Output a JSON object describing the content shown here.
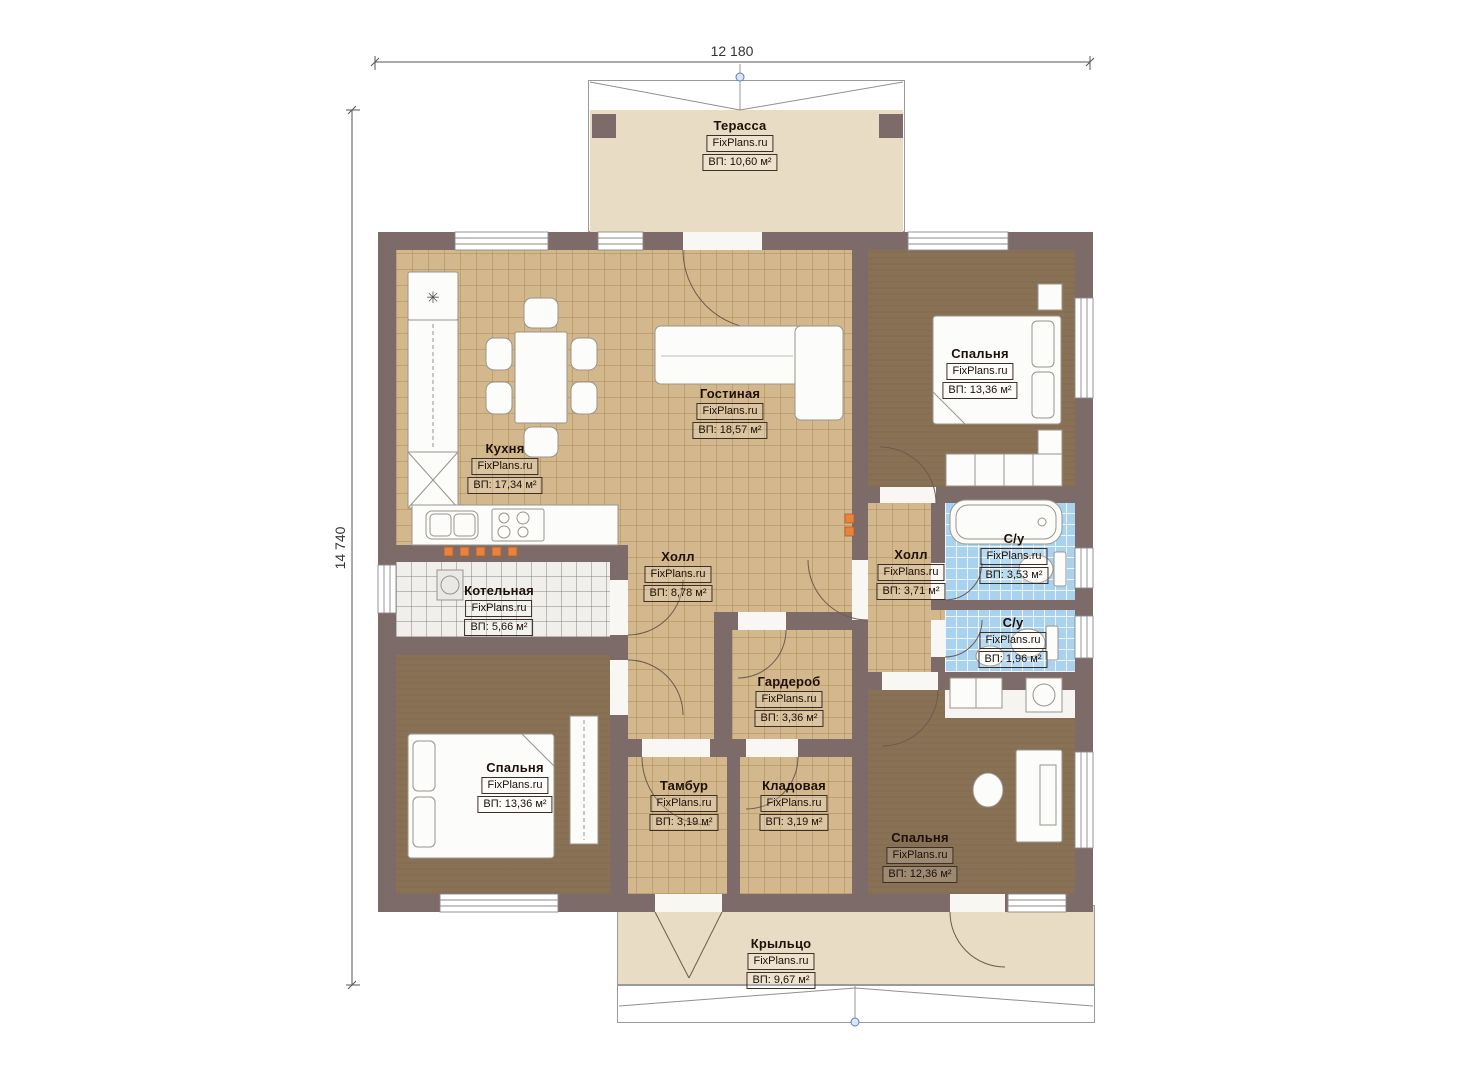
{
  "plan": {
    "watermark": "FixPlans.ru",
    "dimensions": {
      "width_label": "12 180",
      "height_label": "14 740"
    },
    "rooms": [
      {
        "id": "terrace",
        "name": "Терасса",
        "area": "ВП: 10,60 м²"
      },
      {
        "id": "kitchen",
        "name": "Кухня",
        "area": "ВП: 17,34 м²"
      },
      {
        "id": "living",
        "name": "Гостиная",
        "area": "ВП: 18,57 м²"
      },
      {
        "id": "bedroom-top",
        "name": "Спальня",
        "area": "ВП: 13,36 м²"
      },
      {
        "id": "hall-main",
        "name": "Холл",
        "area": "ВП: 8,78 м²"
      },
      {
        "id": "hall-small",
        "name": "Холл",
        "area": "ВП: 3,71 м²"
      },
      {
        "id": "bath-big",
        "name": "С/у",
        "area": "ВП: 3,53 м²"
      },
      {
        "id": "bath-small",
        "name": "С/у",
        "area": "ВП: 1,96 м²"
      },
      {
        "id": "boiler",
        "name": "Котельная",
        "area": "ВП: 5,66 м²"
      },
      {
        "id": "wardrobe",
        "name": "Гардероб",
        "area": "ВП: 3,36 м²"
      },
      {
        "id": "bedroom-left",
        "name": "Спальня",
        "area": "ВП: 13,36 м²"
      },
      {
        "id": "tambour",
        "name": "Тамбур",
        "area": "ВП: 3,19 м²"
      },
      {
        "id": "storage",
        "name": "Кладовая",
        "area": "ВП: 3,19 м²"
      },
      {
        "id": "bedroom-right",
        "name": "Спальня",
        "area": "ВП: 12,36 м²"
      },
      {
        "id": "porch",
        "name": "Крыльцо",
        "area": "ВП: 9,67 м²"
      }
    ],
    "icons": {
      "fridge_snowflake": "✳"
    },
    "colors": {
      "wall": "#7d6b69",
      "floor_tile_tan": "#d3b88d",
      "floor_bedroom": "#897155",
      "floor_bath": "#a9d2ef",
      "floor_boiler": "#f0efec",
      "terrace_beige": "#e8dcc4",
      "radiator_orange": "#e8823c",
      "grip_blue": "#5b7fc4"
    }
  }
}
